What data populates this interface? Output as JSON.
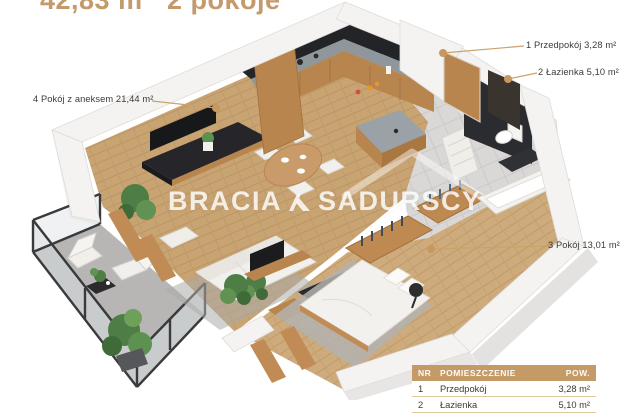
{
  "header": {
    "area": "42,83 m²",
    "rooms": "2 pokoje"
  },
  "watermark": {
    "brand_left": "BRACIA",
    "brand_right": "SADURSCY",
    "logo_icon": "roof-monogram"
  },
  "labels": {
    "living": "4 Pokój z aneksem 21,44 m²",
    "hallway": "1 Przedpokój 3,28 m²",
    "bathroom": "2 Łazienka 5,10 m²",
    "bedroom": "3 Pokój 13,01 m²"
  },
  "legend_table": {
    "headers": {
      "nr": "NR",
      "name": "POMIESZCZENIE",
      "pow": "POW."
    },
    "rows": [
      {
        "nr": "1",
        "name": "Przedpokój",
        "pow": "3,28 m²"
      },
      {
        "nr": "2",
        "name": "Łazienka",
        "pow": "5,10 m²"
      }
    ]
  },
  "colors": {
    "accent_gold": "#c49a6d",
    "leader_line": "#cba26b",
    "leader_dot": "#c8995f",
    "table_header_bg": "#c49a67",
    "label_text": "#3b3b3c",
    "wall": "#f4f3f1",
    "wood_floor": "#c9a473",
    "tile_floor": "#d9d8d6",
    "balcony_floor": "#b7b6b4",
    "cabinet_wood": "#b9854f",
    "dark_feature": "#2b2c30",
    "plant_green": "#4e7d46"
  }
}
